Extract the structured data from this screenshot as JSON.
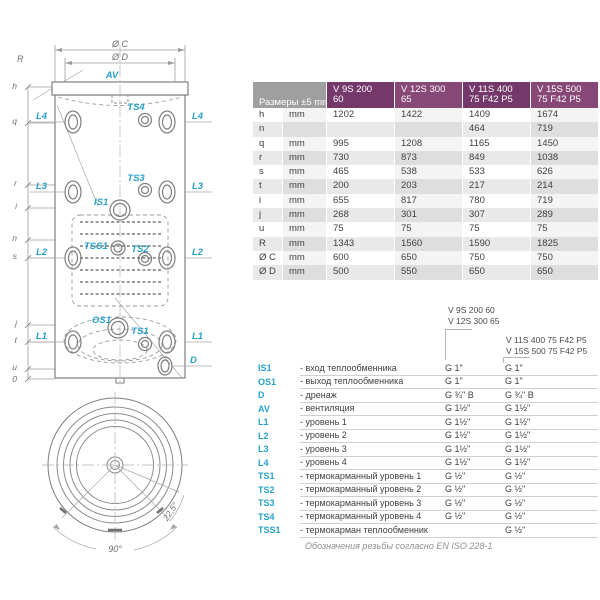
{
  "dim_table": {
    "header_label": "Размеры ±5 mm",
    "columns": [
      {
        "line1": "V 9S 200",
        "line2": "60"
      },
      {
        "line1": "V 12S 300",
        "line2": "65"
      },
      {
        "line1": "V 11S 400",
        "line2": "75 F42 P5"
      },
      {
        "line1": "V 15S 500",
        "line2": "75 F42 P5"
      }
    ],
    "rows": [
      {
        "p": "h",
        "u": "mm",
        "v": [
          "1202",
          "1422",
          "1409",
          "1674"
        ]
      },
      {
        "p": "n",
        "u": "",
        "v": [
          "",
          "",
          "464",
          "719"
        ]
      },
      {
        "p": "q",
        "u": "mm",
        "v": [
          "995",
          "1208",
          "1165",
          "1450"
        ]
      },
      {
        "p": "r",
        "u": "mm",
        "v": [
          "730",
          "873",
          "849",
          "1038"
        ]
      },
      {
        "p": "s",
        "u": "mm",
        "v": [
          "465",
          "538",
          "533",
          "626"
        ]
      },
      {
        "p": "t",
        "u": "mm",
        "v": [
          "200",
          "203",
          "217",
          "214"
        ]
      },
      {
        "p": "i",
        "u": "mm",
        "v": [
          "655",
          "817",
          "780",
          "719"
        ]
      },
      {
        "p": "j",
        "u": "mm",
        "v": [
          "268",
          "301",
          "307",
          "289"
        ]
      },
      {
        "p": "u",
        "u": "mm",
        "v": [
          "75",
          "75",
          "75",
          "75"
        ]
      },
      {
        "p": "R",
        "u": "mm",
        "v": [
          "1343",
          "1560",
          "1590",
          "1825"
        ]
      },
      {
        "p": "Ø C",
        "u": "mm",
        "v": [
          "600",
          "650",
          "750",
          "750"
        ]
      },
      {
        "p": "Ø D",
        "u": "mm",
        "v": [
          "500",
          "550",
          "650",
          "650"
        ]
      }
    ]
  },
  "conn_table": {
    "group1_line1": "V 9S 200 60",
    "group1_line2": "V 12S 300 65",
    "group2_line1": "V 11S 400 75 F42 P5",
    "group2_line2": "V 15S 500 75 F42 P5",
    "rows": [
      {
        "code": "IS1",
        "desc": "- вход теплообменника",
        "v1": "G 1\"",
        "v2": "G 1\""
      },
      {
        "code": "OS1",
        "desc": "- выход теплообменника",
        "v1": "G 1\"",
        "v2": "G 1\""
      },
      {
        "code": "D",
        "desc": "- дренаж",
        "v1": "G ¾\" B",
        "v2": "G ¾\" B"
      },
      {
        "code": "AV",
        "desc": "- вентиляция",
        "v1": "G 1½\"",
        "v2": "G 1½\""
      },
      {
        "code": "L1",
        "desc": "- уровень 1",
        "v1": "G 1½\"",
        "v2": "G 1½\""
      },
      {
        "code": "L2",
        "desc": "- уровень 2",
        "v1": "G 1½\"",
        "v2": "G 1½\""
      },
      {
        "code": "L3",
        "desc": "- уровень 3",
        "v1": "G 1½\"",
        "v2": "G 1½\""
      },
      {
        "code": "L4",
        "desc": "- уровень 4",
        "v1": "G 1½\"",
        "v2": "G 1½\""
      },
      {
        "code": "TS1",
        "desc": "- термокарманный уровень 1",
        "v1": "G ½\"",
        "v2": "G ½\""
      },
      {
        "code": "TS2",
        "desc": "- термокарманный уровень 2",
        "v1": "G ½\"",
        "v2": "G ½\""
      },
      {
        "code": "TS3",
        "desc": "- термокарманный уровень 3",
        "v1": "G ½\"",
        "v2": "G ½\""
      },
      {
        "code": "TS4",
        "desc": "- термокарманный уровень 4",
        "v1": "G ½\"",
        "v2": "G ½\""
      },
      {
        "code": "TSS1",
        "desc": "- термокарман теплообменник",
        "v1": "",
        "v2": "G ½\""
      }
    ],
    "footnote": "Обозначения резьбы согласно EN ISO 228-1"
  },
  "drawing": {
    "dims": {
      "c": "Ø C",
      "d": "Ø D",
      "radius": "R"
    },
    "ticks": {
      "h": "h",
      "q": "q",
      "r": "r",
      "i": "i",
      "n": "n",
      "s": "s",
      "j": "j",
      "t": "t",
      "u": "u",
      "zero": "0"
    },
    "ports": {
      "av": "AV",
      "l4l": "L4",
      "l4r": "L4",
      "ts4": "TS4",
      "l3l": "L3",
      "l3r": "L3",
      "ts3": "TS3",
      "is1": "IS1",
      "tss1": "TSS1",
      "l2l": "L2",
      "l2r": "L2",
      "ts2": "TS2",
      "os1": "OS1",
      "ts1": "TS1",
      "l1l": "L1",
      "l1r": "L1",
      "d": "D"
    },
    "bottom_view": {
      "angle90": "90°",
      "angle225": "22,5°"
    }
  },
  "colors": {
    "accent_blue": "#29a1c9",
    "header_purple_dark": "#74386a",
    "header_purple_light": "#874878",
    "header_gray": "#9f9f9f"
  }
}
